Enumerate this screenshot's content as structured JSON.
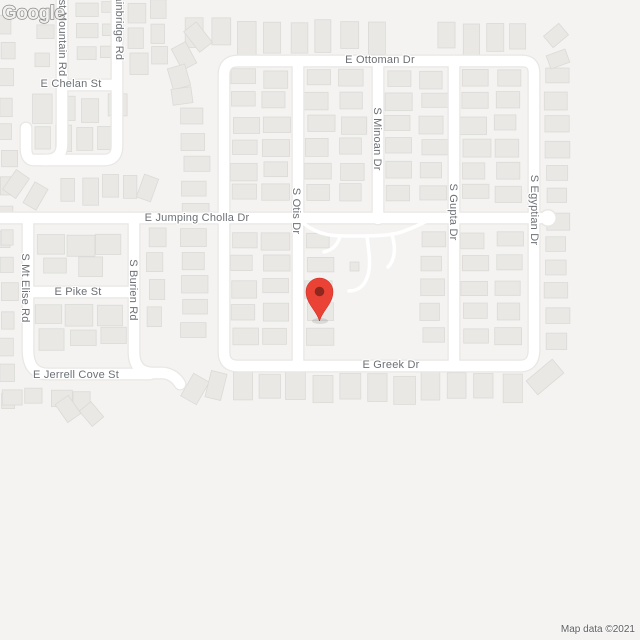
{
  "map": {
    "streets": {
      "mountain": "st Mountain Rd",
      "bainbridge": "Bainbridge Rd",
      "chelan": "E Chelan St",
      "ottoman": "E Ottoman Dr",
      "jumping_cholla": "E Jumping Cholla Dr",
      "otis": "S Otis Dr",
      "minoan": "S Minoan Dr",
      "gupta": "S Gupta Dr",
      "egyptian": "S Egyptian Dr",
      "mt_elise": "S Mt Elise Rd",
      "burien": "S Burien Rd",
      "pike": "E Pike St",
      "jerrell_cove": "E Jerrell Cove St",
      "greek": "E Greek Dr"
    },
    "marker": {
      "color": "#EA4335",
      "inner_color": "#8E271D"
    },
    "logo": "Google",
    "attribution": "Map data ©2021",
    "colors": {
      "background": "#f4f3f1",
      "road": "#ffffff",
      "building": "#e9e8e5",
      "label": "#6c7075"
    }
  }
}
